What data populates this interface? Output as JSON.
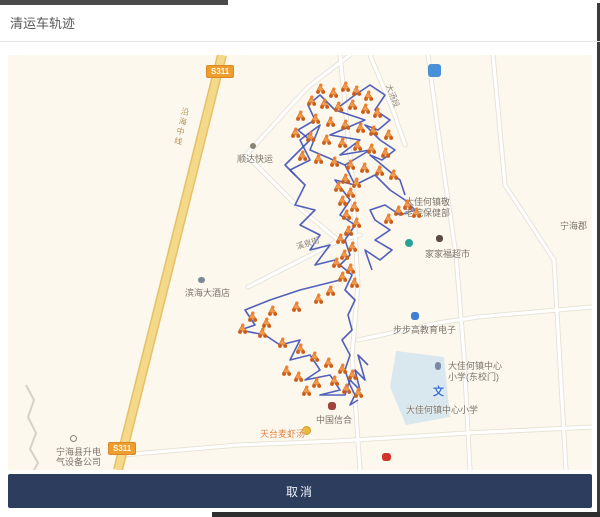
{
  "page": {
    "title": "清运车轨迹"
  },
  "footer": {
    "cancel_label": "取消"
  },
  "map": {
    "road_badge": "S311",
    "labels": [
      "顺达快运",
      "滨海大酒店",
      "大佳何镇敬",
      "老院保健部",
      "家家福超市",
      "步步高教育电子",
      "大佳何镇中心",
      "小学(东校门)",
      "文",
      "大佳何镇中心小学",
      "中国信合",
      "天台麦虾汤",
      "宁海县升电",
      "气设备公司",
      "宁海郡",
      "大汤段",
      "溪泉街",
      "沿海中线"
    ],
    "colors": {
      "trajectory": "#3e4fb5",
      "marker_body": "#f29a4a",
      "marker_wheel": "#cc5c16",
      "main_road": "#f5d98b",
      "map_background": "#fcf8ee",
      "footer_bar": "#2d3d5e",
      "badge": "#ef9d2d"
    },
    "trajectory": {
      "color": "#3e4fb5",
      "paths": [
        [
          [
            347,
            40
          ],
          [
            327,
            55
          ],
          [
            357,
            65
          ],
          [
            322,
            80
          ],
          [
            352,
            85
          ],
          [
            332,
            100
          ],
          [
            362,
            95
          ],
          [
            337,
            110
          ],
          [
            347,
            130
          ],
          [
            327,
            125
          ],
          [
            342,
            145
          ],
          [
            332,
            160
          ],
          [
            347,
            170
          ],
          [
            337,
            185
          ],
          [
            342,
            200
          ],
          [
            332,
            210
          ],
          [
            344,
            220
          ],
          [
            337,
            235
          ],
          [
            347,
            245
          ],
          [
            340,
            260
          ],
          [
            344,
            275
          ],
          [
            334,
            285
          ],
          [
            342,
            300
          ],
          [
            337,
            315
          ],
          [
            342,
            330
          ]
        ],
        [
          [
            337,
            110
          ],
          [
            302,
            95
          ],
          [
            312,
            70
          ],
          [
            292,
            85
          ],
          [
            302,
            105
          ],
          [
            282,
            115
          ],
          [
            297,
            130
          ],
          [
            287,
            150
          ],
          [
            307,
            155
          ],
          [
            292,
            170
          ],
          [
            312,
            180
          ],
          [
            302,
            195
          ],
          [
            322,
            190
          ],
          [
            307,
            210
          ],
          [
            327,
            205
          ]
        ],
        [
          [
            332,
            225
          ],
          [
            292,
            235
          ],
          [
            262,
            245
          ],
          [
            237,
            255
          ],
          [
            247,
            270
          ],
          [
            232,
            275
          ],
          [
            257,
            280
          ],
          [
            272,
            290
          ],
          [
            292,
            285
          ],
          [
            282,
            305
          ],
          [
            302,
            300
          ],
          [
            312,
            315
          ],
          [
            297,
            325
          ],
          [
            322,
            320
          ],
          [
            332,
            335
          ],
          [
            312,
            340
          ],
          [
            337,
            340
          ],
          [
            342,
            325
          ],
          [
            352,
            335
          ],
          [
            347,
            315
          ],
          [
            357,
            325
          ],
          [
            350,
            300
          ],
          [
            360,
            310
          ]
        ],
        [
          [
            347,
            130
          ],
          [
            367,
            120
          ],
          [
            382,
            135
          ],
          [
            397,
            145
          ],
          [
            407,
            155
          ],
          [
            392,
            160
          ],
          [
            377,
            150
          ],
          [
            362,
            155
          ],
          [
            367,
            165
          ],
          [
            382,
            175
          ],
          [
            367,
            185
          ],
          [
            384,
            195
          ],
          [
            372,
            205
          ],
          [
            357,
            195
          ],
          [
            364,
            215
          ]
        ],
        [
          [
            347,
            40
          ],
          [
            362,
            30
          ],
          [
            377,
            40
          ],
          [
            367,
            55
          ],
          [
            382,
            65
          ],
          [
            370,
            75
          ],
          [
            357,
            70
          ],
          [
            372,
            85
          ],
          [
            387,
            95
          ],
          [
            374,
            105
          ],
          [
            362,
            100
          ],
          [
            380,
            115
          ],
          [
            392,
            125
          ],
          [
            397,
            140
          ]
        ],
        [
          [
            327,
            55
          ],
          [
            312,
            40
          ],
          [
            300,
            50
          ],
          [
            307,
            65
          ],
          [
            290,
            75
          ],
          [
            302,
            85
          ],
          [
            287,
            100
          ],
          [
            277,
            110
          ],
          [
            287,
            120
          ]
        ],
        [
          [
            342,
            330
          ],
          [
            347,
            340
          ],
          [
            342,
            350
          ],
          [
            350,
            345
          ]
        ]
      ]
    },
    "markers": {
      "points": [
        [
          312,
          33
        ],
        [
          325,
          37
        ],
        [
          337,
          31
        ],
        [
          348,
          35
        ],
        [
          360,
          40
        ],
        [
          303,
          45
        ],
        [
          316,
          48
        ],
        [
          330,
          51
        ],
        [
          344,
          49
        ],
        [
          357,
          53
        ],
        [
          369,
          57
        ],
        [
          292,
          60
        ],
        [
          307,
          63
        ],
        [
          322,
          66
        ],
        [
          337,
          69
        ],
        [
          352,
          72
        ],
        [
          365,
          75
        ],
        [
          380,
          79
        ],
        [
          287,
          77
        ],
        [
          302,
          81
        ],
        [
          318,
          84
        ],
        [
          334,
          87
        ],
        [
          349,
          90
        ],
        [
          363,
          93
        ],
        [
          377,
          97
        ],
        [
          294,
          100
        ],
        [
          310,
          103
        ],
        [
          326,
          106
        ],
        [
          342,
          109
        ],
        [
          356,
          112
        ],
        [
          371,
          115
        ],
        [
          385,
          119
        ],
        [
          399,
          149
        ],
        [
          408,
          157
        ],
        [
          390,
          155
        ],
        [
          380,
          163
        ],
        [
          337,
          123
        ],
        [
          348,
          127
        ],
        [
          330,
          131
        ],
        [
          342,
          137
        ],
        [
          334,
          145
        ],
        [
          346,
          151
        ],
        [
          338,
          159
        ],
        [
          348,
          167
        ],
        [
          340,
          175
        ],
        [
          332,
          183
        ],
        [
          344,
          191
        ],
        [
          336,
          199
        ],
        [
          328,
          207
        ],
        [
          342,
          213
        ],
        [
          334,
          221
        ],
        [
          346,
          227
        ],
        [
          322,
          235
        ],
        [
          310,
          243
        ],
        [
          288,
          251
        ],
        [
          264,
          255
        ],
        [
          244,
          261
        ],
        [
          234,
          273
        ],
        [
          254,
          277
        ],
        [
          274,
          287
        ],
        [
          292,
          293
        ],
        [
          306,
          301
        ],
        [
          320,
          307
        ],
        [
          334,
          313
        ],
        [
          344,
          319
        ],
        [
          326,
          325
        ],
        [
          308,
          327
        ],
        [
          290,
          321
        ],
        [
          338,
          333
        ],
        [
          350,
          337
        ],
        [
          298,
          335
        ],
        [
          278,
          315
        ],
        [
          258,
          267
        ]
      ]
    }
  }
}
